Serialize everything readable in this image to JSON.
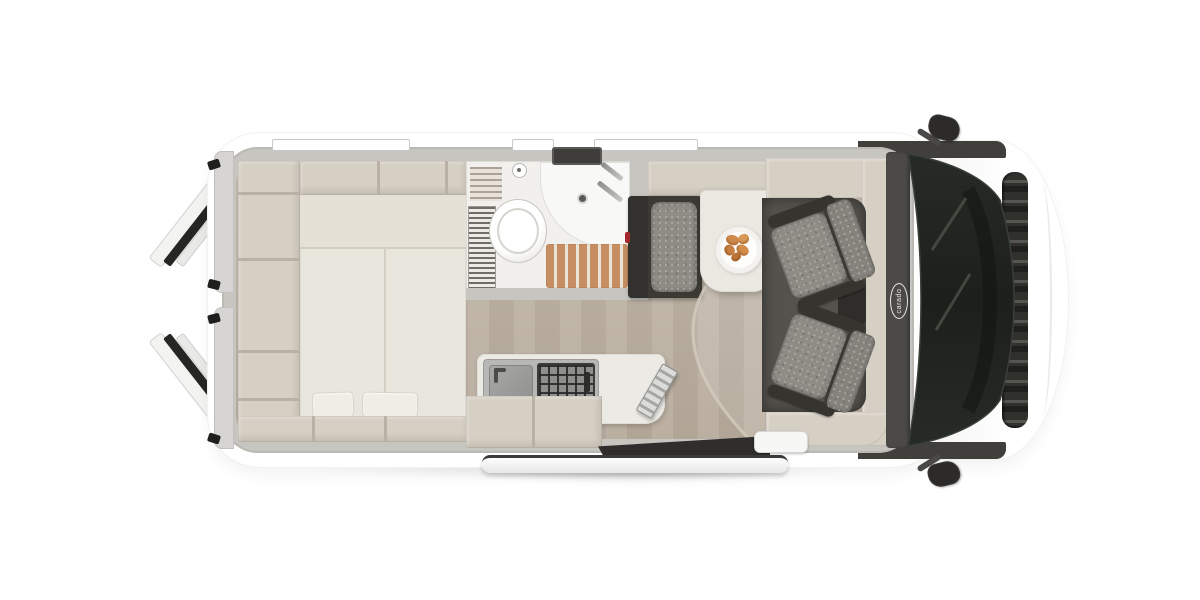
{
  "brand": {
    "logo_text": "carado"
  },
  "scene": {
    "type": "campervan-floorplan-top-view",
    "areas": [
      "rear-doors-open",
      "rear-storage-shelves",
      "rear-double-bed",
      "bathroom",
      "kitchen",
      "dinette",
      "driver-cab"
    ]
  },
  "colors": {
    "bg": "#ffffff",
    "wall": "#c7c5c0",
    "furniture": "#d6cfc3",
    "furniture-dark": "#b9b1a4",
    "bed": "#e9e6dd",
    "floor-light": "#c4b9ab",
    "floor-dark": "#b7ab9c",
    "bath-floor-wood": "#c78e63",
    "bench-dark": "#3a3934",
    "seat-fabric": "#8f8c86",
    "cab-floor": "#54524d",
    "dashboard": "#4b4a47",
    "glass": "#20241f",
    "table": "#eae8e1",
    "croissant": "#d28a4e",
    "accent-red": "#a3282a"
  }
}
